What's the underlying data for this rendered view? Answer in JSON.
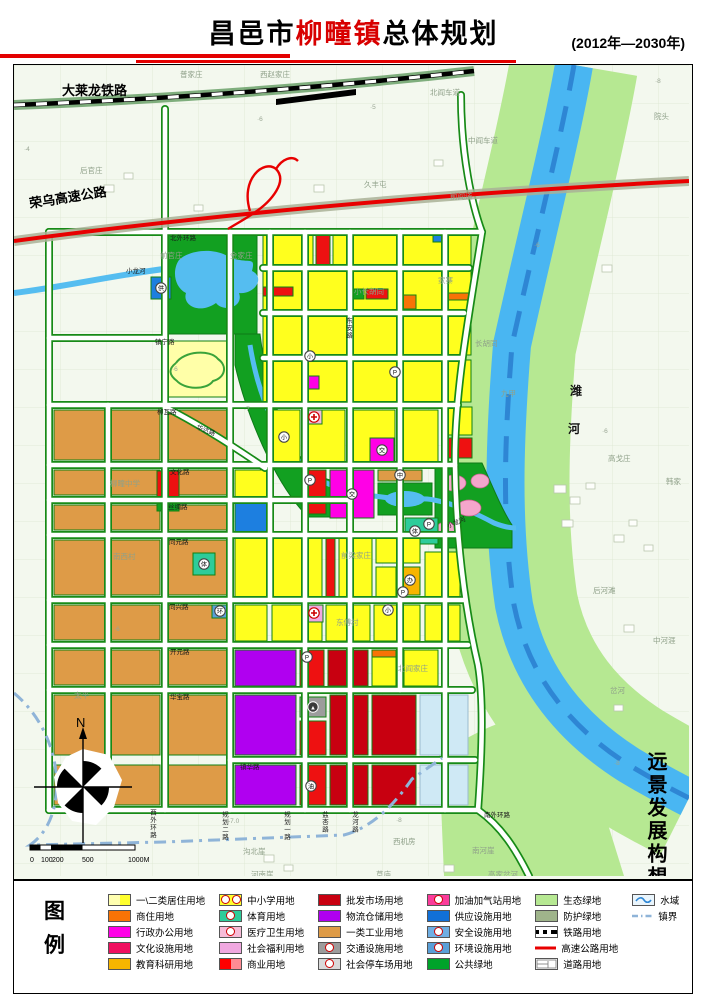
{
  "header": {
    "title_prefix": "昌邑市",
    "title_highlight": "柳疃镇",
    "title_suffix": "总体规划",
    "period": "(2012年—2030年)"
  },
  "map": {
    "side_note": "远景发展构想图",
    "compass_n": "N",
    "scale": {
      "ticks": [
        {
          "t": "0",
          "x": 16
        },
        {
          "t": "100",
          "x": 27
        },
        {
          "t": "200",
          "x": 38
        },
        {
          "t": "500",
          "x": 68
        },
        {
          "t": "1000M",
          "x": 114
        }
      ]
    },
    "labels": [
      {
        "t": "大莱龙铁路",
        "x": 48,
        "y": 30,
        "c": "t-big"
      },
      {
        "t": "荣乌高速公路",
        "x": 16,
        "y": 143,
        "c": "t-big",
        "r": -9
      },
      {
        "t": "潍",
        "x": 556,
        "y": 330,
        "c": "t-water"
      },
      {
        "t": "河",
        "x": 554,
        "y": 368,
        "c": "t-water"
      },
      {
        "t": "小龙河",
        "x": 112,
        "y": 208,
        "c": "t-road",
        "s": 9
      },
      {
        "t": "小龙河",
        "x": 434,
        "y": 463,
        "c": "t-road",
        "r": -22,
        "s": 6
      },
      {
        "t": "普家庄",
        "x": 166,
        "y": 12,
        "c": "t-vil"
      },
      {
        "t": "西赵家庄",
        "x": 246,
        "y": 12,
        "c": "t-vil"
      },
      {
        "t": "北阎车道",
        "x": 416,
        "y": 30,
        "c": "t-vil"
      },
      {
        "t": "院头",
        "x": 640,
        "y": 54,
        "c": "t-vil"
      },
      {
        "t": "中阎车道",
        "x": 454,
        "y": 78,
        "c": "t-vil"
      },
      {
        "t": "后官庄",
        "x": 66,
        "y": 108,
        "c": "t-vil"
      },
      {
        "t": "久丰屯",
        "x": 350,
        "y": 122,
        "c": "t-vil"
      },
      {
        "t": "前阎道",
        "x": 436,
        "y": 134,
        "c": "t-vil"
      },
      {
        "t": "前官庄",
        "x": 146,
        "y": 193,
        "c": "t-vil"
      },
      {
        "t": "金家庄",
        "x": 216,
        "y": 193,
        "c": "t-vil"
      },
      {
        "t": "小长胡同",
        "x": 340,
        "y": 229,
        "c": "t-vil"
      },
      {
        "t": "家寨",
        "x": 424,
        "y": 218,
        "c": "t-vil"
      },
      {
        "t": "长胡同",
        "x": 461,
        "y": 281,
        "c": "t-vil"
      },
      {
        "t": "九甲",
        "x": 487,
        "y": 331,
        "c": "t-vil"
      },
      {
        "t": "高戈庄",
        "x": 594,
        "y": 396,
        "c": "t-vil"
      },
      {
        "t": "韩家",
        "x": 652,
        "y": 419,
        "c": "t-vil"
      },
      {
        "t": "后河滩",
        "x": 579,
        "y": 528,
        "c": "t-vil"
      },
      {
        "t": "中河涯",
        "x": 639,
        "y": 578,
        "c": "t-vil"
      },
      {
        "t": "岔河",
        "x": 596,
        "y": 628,
        "c": "t-vil"
      },
      {
        "t": "柳疃中学",
        "x": 96,
        "y": 421,
        "c": "t-vil"
      },
      {
        "t": "南西村",
        "x": 99,
        "y": 494,
        "c": "t-vil"
      },
      {
        "t": "太平",
        "x": 60,
        "y": 633,
        "c": "t-vil"
      },
      {
        "t": "前梁家庄",
        "x": 327,
        "y": 493,
        "c": "t-vil"
      },
      {
        "t": "东傅村",
        "x": 322,
        "y": 560,
        "c": "t-vil"
      },
      {
        "t": "北阎家庄",
        "x": 384,
        "y": 606,
        "c": "t-vil"
      },
      {
        "t": "西机房",
        "x": 379,
        "y": 779,
        "c": "t-vil"
      },
      {
        "t": "沟北崖",
        "x": 229,
        "y": 789,
        "c": "t-vil"
      },
      {
        "t": "河南崖",
        "x": 237,
        "y": 812,
        "c": "t-vil"
      },
      {
        "t": "草庙",
        "x": 362,
        "y": 812,
        "c": "t-vil"
      },
      {
        "t": "南河崖",
        "x": 458,
        "y": 788,
        "c": "t-vil"
      },
      {
        "t": "高家岔河",
        "x": 474,
        "y": 812,
        "c": "t-vil"
      },
      {
        "t": "北外环路",
        "x": 156,
        "y": 175,
        "c": "t-road"
      },
      {
        "t": "镇宁路",
        "x": 141,
        "y": 279,
        "c": "t-road"
      },
      {
        "t": "柳瓦路",
        "x": 143,
        "y": 349,
        "c": "t-road"
      },
      {
        "t": "华达路",
        "x": 182,
        "y": 364,
        "c": "t-road",
        "r": 20
      },
      {
        "t": "文化路",
        "x": 156,
        "y": 409,
        "c": "t-road"
      },
      {
        "t": "丝绸路",
        "x": 154,
        "y": 444,
        "c": "t-road"
      },
      {
        "t": "同元路",
        "x": 155,
        "y": 479,
        "c": "t-road"
      },
      {
        "t": "同兴路",
        "x": 155,
        "y": 544,
        "c": "t-road"
      },
      {
        "t": "开元路",
        "x": 156,
        "y": 589,
        "c": "t-road"
      },
      {
        "t": "华宝路",
        "x": 156,
        "y": 634,
        "c": "t-road"
      },
      {
        "t": "镇华路",
        "x": 226,
        "y": 704,
        "c": "t-road"
      },
      {
        "t": "东安路",
        "x": 334,
        "y": 252,
        "c": "t-road",
        "v": true
      },
      {
        "t": "西外环路",
        "x": 138,
        "y": 744,
        "c": "t-road",
        "v": true
      },
      {
        "t": "规划二路",
        "x": 210,
        "y": 746,
        "c": "t-road",
        "v": true
      },
      {
        "t": "规划一路",
        "x": 272,
        "y": 746,
        "c": "t-road",
        "v": true
      },
      {
        "t": "盐杏路",
        "x": 310,
        "y": 746,
        "c": "t-road",
        "v": true
      },
      {
        "t": "龙河路",
        "x": 340,
        "y": 746,
        "c": "t-road",
        "v": true
      },
      {
        "t": "南外环路",
        "x": 470,
        "y": 752,
        "c": "t-road"
      },
      {
        "t": "·5",
        "x": 356,
        "y": 44,
        "c": "t-elev"
      },
      {
        "t": "·4",
        "x": 10,
        "y": 86,
        "c": "t-elev"
      },
      {
        "t": "·6",
        "x": 243,
        "y": 56,
        "c": "t-elev"
      },
      {
        "t": "·6",
        "x": 588,
        "y": 368,
        "c": "t-elev"
      },
      {
        "t": "·8",
        "x": 641,
        "y": 18,
        "c": "t-elev"
      },
      {
        "t": "-7.0",
        "x": 214,
        "y": 758,
        "c": "t-elev"
      },
      {
        "t": "·8",
        "x": 382,
        "y": 757,
        "c": "t-elev"
      },
      {
        "t": "·6",
        "x": 158,
        "y": 306,
        "c": "t-elev"
      },
      {
        "t": "·7",
        "x": 230,
        "y": 346,
        "c": "t-elev"
      },
      {
        "t": "·6",
        "x": 100,
        "y": 566,
        "c": "t-elev"
      },
      {
        "t": "·6",
        "x": 520,
        "y": 182,
        "c": "t-elev"
      },
      {
        "t": "·8",
        "x": 600,
        "y": 700,
        "c": "t-elev"
      }
    ],
    "icons": [
      {
        "ch": "小",
        "x": 270,
        "y": 372
      },
      {
        "ch": "小",
        "x": 296,
        "y": 291
      },
      {
        "ch": "小",
        "x": 374,
        "y": 545
      },
      {
        "ch": "中",
        "x": 386,
        "y": 410
      },
      {
        "ch": "P",
        "x": 381,
        "y": 307
      },
      {
        "ch": "P",
        "x": 296,
        "y": 415
      },
      {
        "ch": "P",
        "x": 415,
        "y": 459
      },
      {
        "ch": "P",
        "x": 293,
        "y": 592
      },
      {
        "ch": "P",
        "x": 389,
        "y": 527
      },
      {
        "ch": "交",
        "x": 338,
        "y": 429
      },
      {
        "ch": "交",
        "x": 368,
        "y": 385
      },
      {
        "ch": "体",
        "x": 401,
        "y": 466
      },
      {
        "ch": "体",
        "x": 190,
        "y": 499
      },
      {
        "ch": "供",
        "x": 147,
        "y": 223
      },
      {
        "ch": "环",
        "x": 206,
        "y": 546
      },
      {
        "ch": "油",
        "x": 297,
        "y": 721
      },
      {
        "ch": "办",
        "x": 396,
        "y": 515
      },
      {
        "ch": "医",
        "x": 300,
        "y": 352,
        "type": "cross"
      },
      {
        "ch": "福",
        "x": 300,
        "y": 548,
        "type": "cross"
      },
      {
        "ch": "▲",
        "x": 299,
        "y": 642,
        "type": "tri"
      }
    ]
  },
  "legend": {
    "title": "图例",
    "columns": [
      [
        {
          "label": "一\\二类居住用地",
          "sw": "split",
          "c1": "#FFFFB0",
          "c2": "#FFFF2E"
        },
        {
          "label": "商住用地",
          "sw": "solid",
          "c1": "#F97306"
        },
        {
          "label": "行政办公用地",
          "sw": "solid",
          "c1": "#FF00E6"
        },
        {
          "label": "文化设施用地",
          "sw": "solid",
          "c1": "#F01060"
        },
        {
          "label": "教育科研用地",
          "sw": "solid",
          "c1": "#F7B500"
        }
      ],
      [
        {
          "label": "中小学用地",
          "sw": "icon2",
          "c1": "#FFFF2E"
        },
        {
          "label": "体育用地",
          "sw": "icon",
          "c1": "#2ECC9A"
        },
        {
          "label": "医疗卫生用地",
          "sw": "icon",
          "c1": "#F7BCD8"
        },
        {
          "label": "社会福利用地",
          "sw": "solid",
          "c1": "#F0A8E0"
        },
        {
          "label": "商业用地",
          "sw": "split",
          "c1": "#FF0000",
          "c2": "#FF8C94"
        }
      ],
      [
        {
          "label": "批发市场用地",
          "sw": "solid",
          "c1": "#C80010"
        },
        {
          "label": "物流仓储用地",
          "sw": "solid",
          "c1": "#B000F0"
        },
        {
          "label": "一类工业用地",
          "sw": "solid",
          "c1": "#DE9B47"
        },
        {
          "label": "交通设施用地",
          "sw": "icon",
          "c1": "#9C9C9C"
        },
        {
          "label": "社会停车场用地",
          "sw": "icon",
          "c1": "#D9D9D9"
        }
      ],
      [
        {
          "label": "加油加气站用地",
          "sw": "icon",
          "c1": "#FA3C9B"
        },
        {
          "label": "供应设施用地",
          "sw": "solid",
          "c1": "#1170D8"
        },
        {
          "label": "安全设施用地",
          "sw": "icon",
          "c1": "#6FAEE3"
        },
        {
          "label": "环境设施用地",
          "sw": "icon",
          "c1": "#5A9FD8"
        },
        {
          "label": "公共绿地",
          "sw": "solid",
          "c1": "#00A32A"
        }
      ],
      [
        {
          "label": "生态绿地",
          "sw": "solid",
          "c1": "#B6E892"
        },
        {
          "label": "防护绿地",
          "sw": "solid",
          "c1": "#9FB48B"
        },
        {
          "label": "铁路用地",
          "sw": "rail"
        },
        {
          "label": "高速公路用地",
          "sw": "hwy"
        },
        {
          "label": "道路用地",
          "sw": "road"
        }
      ],
      [
        {
          "label": "水域",
          "sw": "water"
        },
        {
          "label": "镇界",
          "sw": "bound"
        }
      ]
    ]
  },
  "colors": {
    "accent_red": "#e30000",
    "river": "#49B6F2",
    "eco": "#B6E892",
    "park": "#12A021"
  }
}
